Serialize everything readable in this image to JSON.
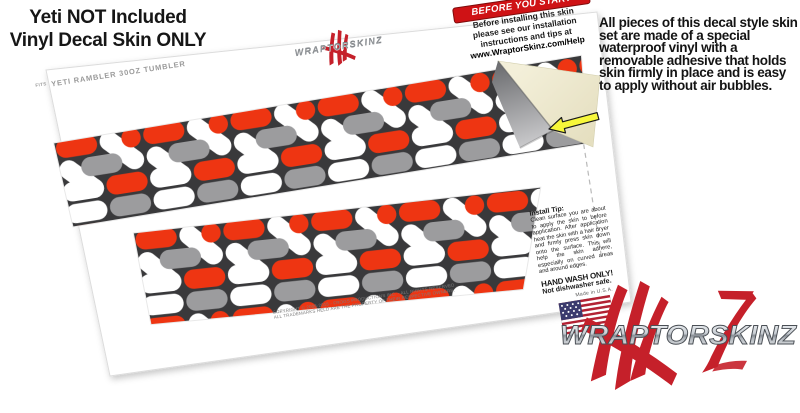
{
  "header": {
    "line1": "Yeti NOT Included",
    "line2": "Vinyl Decal Skin ONLY"
  },
  "description": {
    "text": "All pieces of this decal style skin set are made of a special waterproof vinyl with a removable adhesive that holds skin firmly in place and is easy to apply without air bubbles."
  },
  "sheet": {
    "brand_logo_text": "WRAPTORSKINZ",
    "fits_prefix": "FITS",
    "fits_label": "Yeti Rambler 30oz Tumbler",
    "before_you_start": {
      "title": "BEFORE YOU START",
      "lines": [
        "Before installing this skin",
        "please see our installation",
        "instructions and tips at"
      ],
      "link": "www.WraptorSkinz.com/Help"
    },
    "install_tip": {
      "title": "Install Tip:",
      "body": "Clean surface you are about to apply the skin to before application. After application heat the skin with a hair dryer and firmly press skin down onto the surface. This will help the skin adhere, especially on curved areas and around edges."
    },
    "hand_wash": {
      "title": "HAND WASH ONLY!",
      "subtitle": "Not dishwasher safe."
    },
    "made_in": "Made in U.S.A.",
    "copyright_line1": "COPYRIGHT © 2008-2015 - FROGS PRODUCTIONS INC. - ALL RIGHTS RESERVED",
    "copyright_line2": "ALL TRADEMARKS HELD ARE THE PROPERTY OF THEIR RESPECTIVE OWNERS."
  },
  "watermark": {
    "brand": "WRAPTORSKINZ"
  },
  "pattern": {
    "name": "locknodes-red-gray-white",
    "colors": {
      "background": "#39393b",
      "white": "#ffffff",
      "red": "#ee3512",
      "gray": "#9c9c9e"
    }
  },
  "colors": {
    "banner_red": "#cf1215",
    "logo_red": "#c5202a",
    "arrow_yellow": "#f7f73a",
    "backing_cream": "#efeacd",
    "sheet_edge": "#dcdcdc"
  }
}
